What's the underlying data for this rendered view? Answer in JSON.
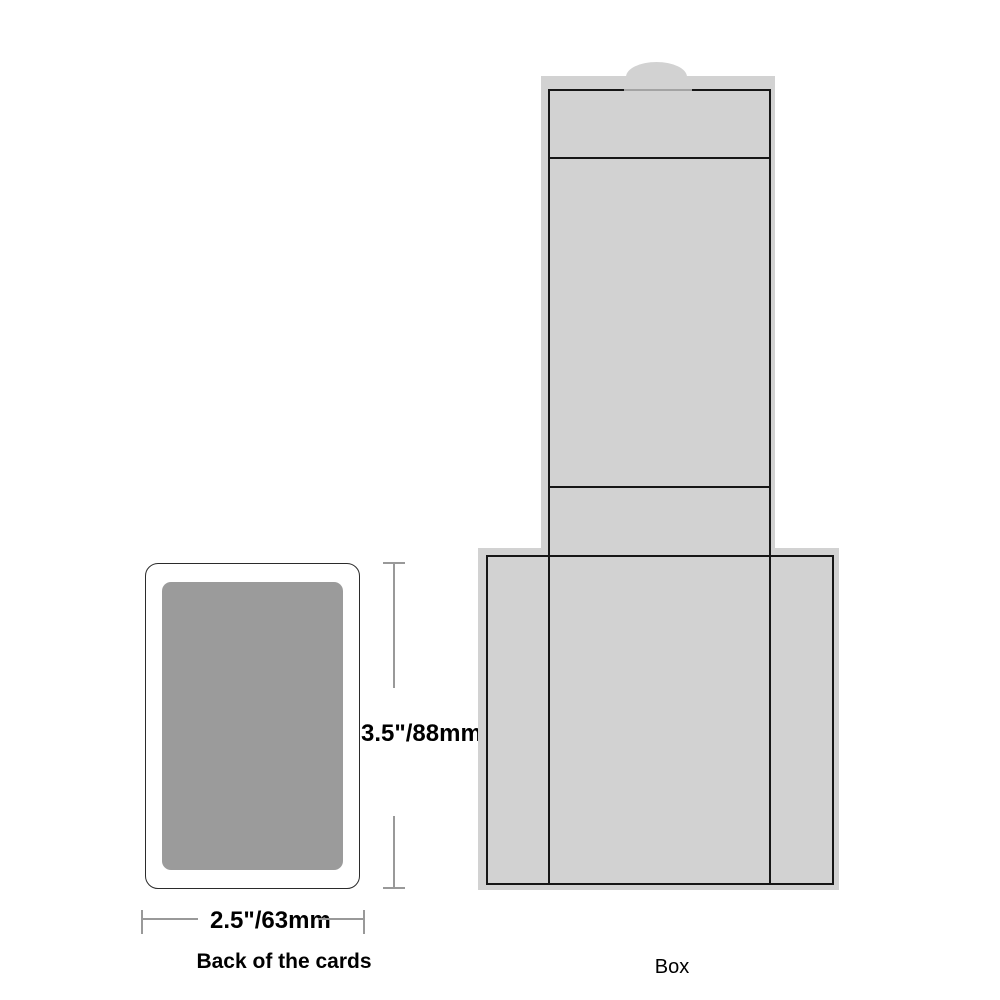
{
  "diagram": {
    "card": {
      "caption": "Back of the cards",
      "height_label": "3.5\"/88mm",
      "width_label": "2.5\"/63mm",
      "back_fill_color": "#9B9B9B",
      "outline_color": "#2B2B2B"
    },
    "box": {
      "caption": "Box",
      "fill_color": "#D2D2D2",
      "cutline_color": "#161616"
    },
    "colors": {
      "background": "#FFFFFF",
      "dimension_line": "#999999",
      "text": "#000000"
    }
  }
}
